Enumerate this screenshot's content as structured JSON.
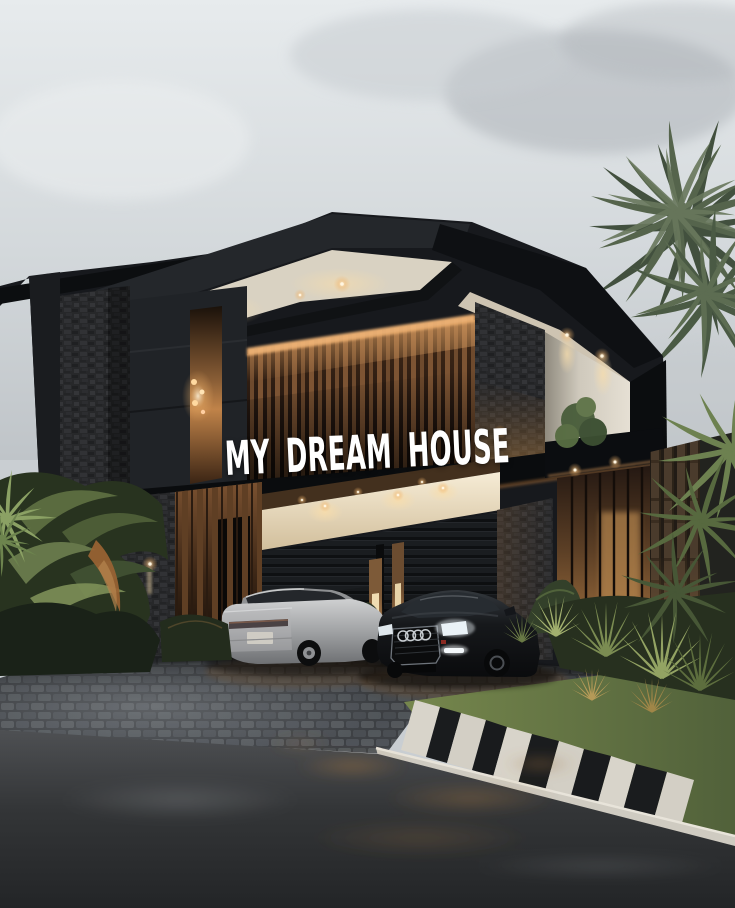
{
  "overlay": {
    "caption": "MY DREAM HOUSE",
    "text_color": "#ffffff"
  },
  "scene": {
    "setting": "Modern two-story black luxury house at dusk under an overcast sky, with a silver sedan and a black Audi sedan parked on a cobblestone driveway, tropical landscaping and a palm tree",
    "vehicles": [
      "silver sedan",
      "black audi sedan"
    ],
    "landscaping": [
      "palm tree",
      "tropical ferns",
      "spiky grasses",
      "lawn with stepping stones"
    ],
    "lighting": [
      "warm recessed downlights",
      "backlit wood slat wall",
      "pendant lights",
      "garage soffit lights"
    ]
  },
  "palette": {
    "sky_top": "#e6eaec",
    "sky_bottom": "#c1c6ca",
    "structure_black": "#101215",
    "stone_dark": "#27282a",
    "wood_warm": "#7d5433",
    "glow_warm": "#f0b476",
    "soffit_cream": "#e0d8c6",
    "stucco_white": "#ddd7cb",
    "driveway_gray": "#54575a",
    "road_asphalt": "#2b2d30",
    "grass_green": "#6b7c48",
    "car_silver": "#b0b2b4",
    "car_black": "#101214"
  }
}
